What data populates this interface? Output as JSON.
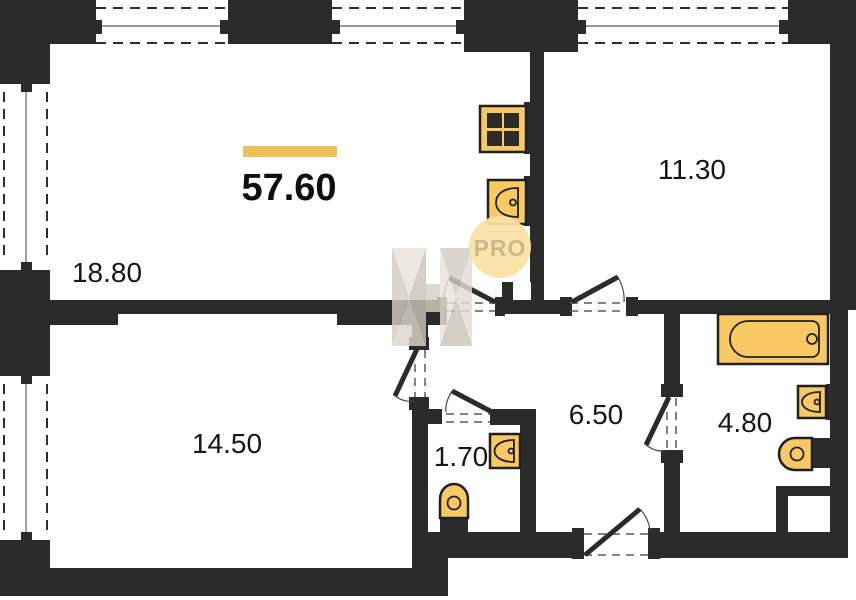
{
  "floorplan": {
    "total_area": "57.60",
    "pro_badge": "PRO",
    "rooms": [
      {
        "id": "living-kitchen",
        "area": "18.80"
      },
      {
        "id": "bedroom-top-right",
        "area": "11.30"
      },
      {
        "id": "bedroom-bottom-left",
        "area": "14.50"
      },
      {
        "id": "hallway",
        "area": "6.50"
      },
      {
        "id": "wc",
        "area": "1.70"
      },
      {
        "id": "bathroom",
        "area": "4.80"
      }
    ]
  },
  "colors": {
    "wall": "#2b2b2b",
    "fixture": "#f8c863",
    "accent": "#eec05a",
    "probg": "#fbe3a4",
    "protext": "#c6b88c",
    "paper": "#ffffff"
  }
}
